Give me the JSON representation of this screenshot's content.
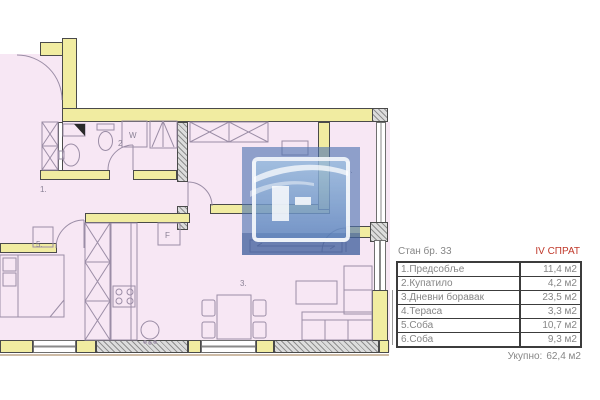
{
  "legend": {
    "unit_title": "Стан бр. 33",
    "floor_label": "IV СПРАТ",
    "rows": [
      {
        "label": "1.Предсобље",
        "area": "11,4 м2"
      },
      {
        "label": "2.Купатило",
        "area": "4,2 м2"
      },
      {
        "label": "3.Дневни боравак",
        "area": "23,5 м2"
      },
      {
        "label": "4.Тераса",
        "area": "3,3 м2"
      },
      {
        "label": "5.Соба",
        "area": "10,7 м2"
      },
      {
        "label": "6.Соба",
        "area": "9,3 м2"
      }
    ],
    "total_label": "Укупно:",
    "total_area": "62,4 м2"
  },
  "plan": {
    "room_marks": {
      "r1": "1.",
      "r2": "2",
      "r3": "3.",
      "r4": "4.",
      "r5": "5."
    },
    "appliance_marks": {
      "washer": "W",
      "fridge": "F"
    }
  },
  "colors": {
    "floor_pink": "#f7e7f4",
    "wall_yellow": "#f1eca1",
    "accent_red": "#c0392b",
    "watermark_blue": "#4d72b0",
    "text_gray": "#868686"
  }
}
